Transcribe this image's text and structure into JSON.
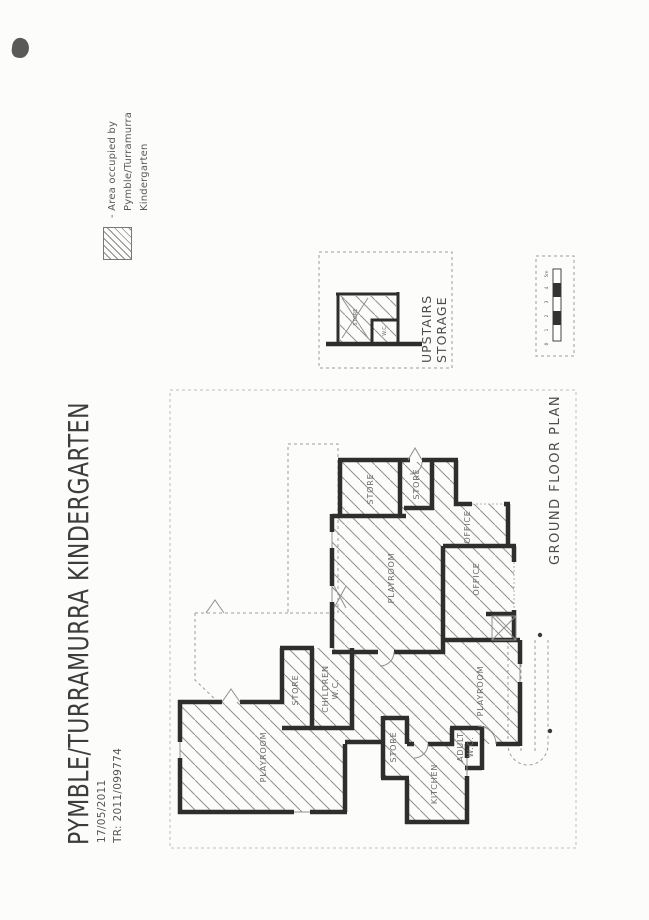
{
  "header": {
    "title": "PYMBLE/TURRAMURRA KINDERGARTEN",
    "date": "17/05/2011",
    "reference": "TR: 2011/099774"
  },
  "legend": {
    "line1": "- Area occupied by",
    "line2": "Pymble/Turramurra",
    "line3": "Kindergarten"
  },
  "plan": {
    "ground_floor_title": "GROUND FLOOR PLAN",
    "upstairs_title": {
      "line1": "UPSTAIRS",
      "line2": "STORAGE"
    },
    "room_labels": {
      "playroom": "PLAYROOM",
      "store": "STORE",
      "office": "OFFICE",
      "kitchen": "KITCHEN",
      "children_wc": [
        "CHILDREN",
        "W.C."
      ],
      "adult_wc": [
        "ADULT",
        "W.C."
      ],
      "upstairs_store": "STORE",
      "upstairs_wc": "W.C"
    },
    "scale_bar": {
      "ticks": [
        "5m",
        "4",
        "3",
        "2",
        "1",
        "0"
      ]
    }
  },
  "colors": {
    "paper": "#fcfcfb",
    "wall": "#2e2e2e",
    "hatch": "#8f8f8f",
    "dashed_line": "#9c9c9c",
    "title_text": "#3d3d3d",
    "label_text": "#6b6b6b"
  }
}
